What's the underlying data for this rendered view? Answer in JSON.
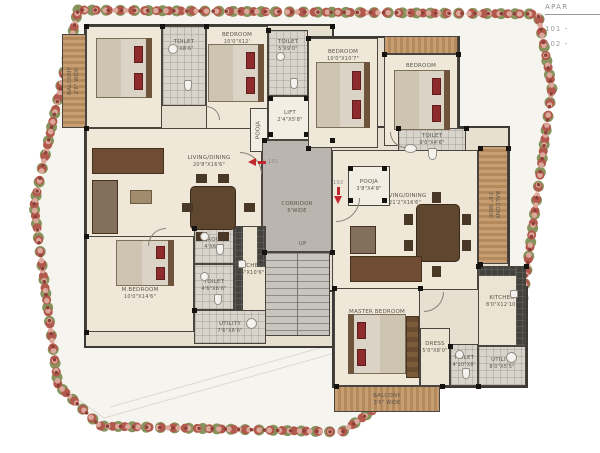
{
  "legend": {
    "title": "APAR",
    "items": [
      "101 -",
      "102 -"
    ]
  },
  "markers": {
    "m101": "101",
    "m102": "102"
  },
  "stairs": {
    "up": "UP"
  },
  "colors": {
    "arrow_red": "#c1272d",
    "pillow_red": "#8e2b2c",
    "hedge_red": "#b2594d",
    "hedge_pink": "#dca89b",
    "hedge_green": "#86935d",
    "wood_light": "#c79e72",
    "wood_dark": "#b48a5c",
    "wall": "#3e3b37"
  },
  "rooms": {
    "balcony_tl": {
      "name": "BALCONY",
      "dims": "2'6\" WIDE"
    },
    "bedroom_tl": {
      "name": "BEDROOM",
      "dims": "10'0\"X12'0\""
    },
    "toilet_1": {
      "name": "TOILET",
      "dims": "5'X8'6\""
    },
    "bedroom_t2": {
      "name": "BEDROOM",
      "dims": "10'0\"X12'"
    },
    "toilet_2": {
      "name": "TOILET",
      "dims": "5'X9'0\""
    },
    "pooja_101": {
      "name": "POOJA",
      "dims": ""
    },
    "lift": {
      "name": "LIFT",
      "dims": "2'4\"X5'8\""
    },
    "living_101": {
      "name": "LIVING/DINING",
      "dims": "20'8\"X16'6\""
    },
    "corridor": {
      "name": "CORRIDOR",
      "dims": "6'WIDE"
    },
    "m_bedroom": {
      "name": "M.BEDROOM",
      "dims": "10'0\"X14'6\""
    },
    "p_room": {
      "name": "P.ROOM",
      "dims": "4'X6'6\""
    },
    "toilet_m101": {
      "name": "TOILET",
      "dims": "4'6\"X6'6\""
    },
    "kitchen_101": {
      "name": "KITCHEN",
      "dims": "7'6\"X10'6\""
    },
    "utility_101": {
      "name": "UTILITY",
      "dims": "7'6\"X6'6\""
    },
    "bedroom_t3": {
      "name": "BEDROOM",
      "dims": "10'0\"X10'7\""
    },
    "bedroom_tr": {
      "name": "BEDROOM",
      "dims": "10'0\"X12'6\""
    },
    "toilet_102": {
      "name": "TOILET",
      "dims": "9'0\"X4'6\""
    },
    "balcony_r": {
      "name": "BALCONY",
      "dims": "3'6\" WIDE"
    },
    "pooja_102": {
      "name": "POOJA",
      "dims": "3'8\"X4'8\""
    },
    "living_102": {
      "name": "LIVING/DINING",
      "dims": "21'2\"X16'6\""
    },
    "master_102": {
      "name": "MASTER BEDROOM",
      "dims": "10'8\"X12'4\""
    },
    "dress": {
      "name": "DRESS",
      "dims": "5'0\"X8'0\""
    },
    "toilet_m102": {
      "name": "TOILET",
      "dims": "4'10\"X8'"
    },
    "kitchen_102": {
      "name": "KITCHEN",
      "dims": "8'0\"X12'10\""
    },
    "utility_102": {
      "name": "UTILITY",
      "dims": "8'0\"X5'5\""
    },
    "balcony_b": {
      "name": "BALCONY",
      "dims": "3'6\" WIDE"
    }
  }
}
